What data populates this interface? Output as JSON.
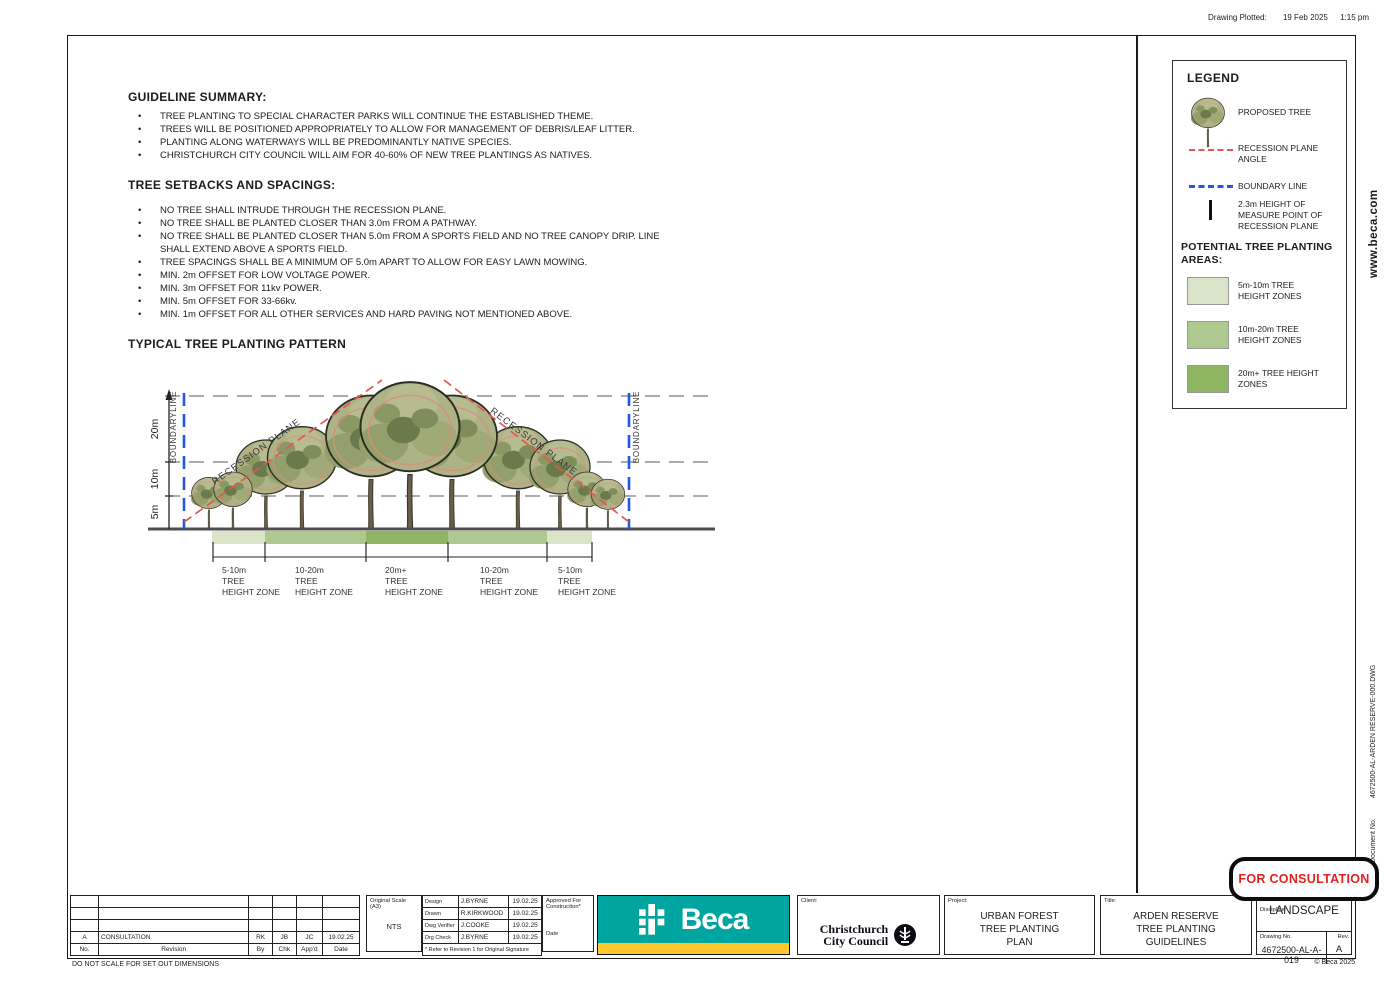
{
  "colors": {
    "beca_teal": "#00a5a0",
    "beca_yellow": "#ffc72c",
    "stamp_red": "#e8201d",
    "boundary_blue": "#2059e0",
    "recession_red": "#e4574f",
    "zone_light_green": "#d9e4c8",
    "zone_mid_green": "#adc98f",
    "zone_dark_green": "#8fb763"
  },
  "page": {
    "plot_label": "Drawing Plotted:",
    "plot_date": "19 Feb 2025",
    "plot_time": "1:15 pm",
    "website": "www.beca.com",
    "document_no_label": "Document No.",
    "document_no_value": "4672500-AL-ARDEN RESERVE-000.DWG",
    "do_not_scale_note": "DO NOT SCALE FOR SET OUT DIMENSIONS",
    "copyright": "© Beca 2025",
    "consultation_stamp": "FOR CONSULTATION"
  },
  "guideline_summary": {
    "heading": "GUIDELINE SUMMARY:",
    "bullets": [
      "TREE PLANTING TO SPECIAL CHARACTER PARKS WILL CONTINUE THE ESTABLISHED THEME.",
      "TREES WILL BE POSITIONED APPROPRIATELY TO ALLOW FOR MANAGEMENT OF DEBRIS/LEAF LITTER.",
      "PLANTING ALONG WATERWAYS WILL BE PREDOMINANTLY NATIVE SPECIES.",
      "CHRISTCHURCH CITY COUNCIL WILL AIM FOR 40-60% OF NEW TREE PLANTINGS AS NATIVES."
    ]
  },
  "tree_setbacks": {
    "heading": "TREE SETBACKS AND SPACINGS:",
    "bullets": [
      "NO TREE SHALL INTRUDE THROUGH THE RECESSION PLANE.",
      "NO TREE SHALL BE PLANTED CLOSER THAN 3.0m FROM A PATHWAY.",
      "NO TREE SHALL BE PLANTED CLOSER THAN 5.0m FROM A SPORTS FIELD AND NO TREE CANOPY DRIP. LINE SHALL EXTEND ABOVE A SPORTS FIELD.",
      "TREE SPACINGS SHALL BE A MINIMUM OF 5.0m APART TO ALLOW FOR EASY LAWN MOWING.",
      "MIN. 2m OFFSET FOR LOW VOLTAGE POWER.",
      "MIN. 3m OFFSET FOR 11kv POWER.",
      "MIN. 5m OFFSET FOR 33-66kv.",
      "MIN. 1m OFFSET FOR ALL OTHER SERVICES AND HARD PAVING NOT MENTIONED ABOVE."
    ]
  },
  "diagram": {
    "heading": "TYPICAL TREE PLANTING PATTERN",
    "axis_labels": [
      "5m",
      "10m",
      "20m"
    ],
    "boundary_label": "BOUNDARYLINE",
    "recession_label": "RECESSION PLANE",
    "zone_ranges": [
      "5-10m",
      "10-20m",
      "20m+",
      "10-20m",
      "5-10m"
    ],
    "zone_line2": "TREE",
    "zone_line3": "HEIGHT ZONE"
  },
  "legend": {
    "title": "LEGEND",
    "proposed_tree": "PROPOSED TREE",
    "recession_plane_angle": "RECESSION PLANE ANGLE",
    "boundary_line": "BOUNDARY LINE",
    "measure_point": "2.3m HEIGHT OF MEASURE POINT OF RECESSION PLANE",
    "areas_heading": "POTENTIAL TREE PLANTING AREAS:",
    "areas": [
      {
        "label": "5m-10m TREE HEIGHT ZONES",
        "color": "#d9e4c8"
      },
      {
        "label": "10m-20m TREE HEIGHT ZONES",
        "color": "#adc98f"
      },
      {
        "label": "20m+ TREE HEIGHT ZONES",
        "color": "#8fb763"
      }
    ]
  },
  "title_block": {
    "revision_table": {
      "headers": {
        "no": "No.",
        "revision": "Revision",
        "by": "By",
        "chk": "Chk",
        "appd": "App'd",
        "date": "Date"
      },
      "rows": [
        {
          "no": "A",
          "revision": "CONSULTATION",
          "by": "RK",
          "chk": "JB",
          "appd": "JC",
          "date": "19.02.25"
        }
      ]
    },
    "scale": {
      "label": "Original Scale (A3)",
      "value": "NTS"
    },
    "signoff": {
      "rows": [
        {
          "role": "Design",
          "name": "J.BYRNE",
          "date": "19.02.25"
        },
        {
          "role": "Drawn",
          "name": "R.KIRKWOOD",
          "date": "19.02.25"
        },
        {
          "role": "Dwg Verifier",
          "name": "J.COOKE",
          "date": "19.02.25"
        },
        {
          "role": "Drg Check",
          "name": "J.BYRNE",
          "date": "19.02.25"
        }
      ],
      "footnote": "* Refer to Revision 1 for Original Signature",
      "approved_label": "Approved For Construction*",
      "approved_date_label": "Date"
    },
    "company_logo_text": "Beca",
    "client": {
      "label": "Client:",
      "name_line1": "Christchurch",
      "name_line2": "City Council"
    },
    "project": {
      "label": "Project:",
      "lines": [
        "URBAN FOREST",
        "TREE PLANTING",
        "PLAN"
      ]
    },
    "title": {
      "label": "Title:",
      "lines": [
        "ARDEN RESERVE",
        "TREE PLANTING",
        "GUIDELINES"
      ]
    },
    "discipline": {
      "label": "Discipline:",
      "value": "LANDSCAPE"
    },
    "drawing_no": {
      "label": "Drawing No.",
      "value": "4672500-AL-A-019"
    },
    "rev": {
      "label": "Rev.",
      "value": "A"
    }
  }
}
